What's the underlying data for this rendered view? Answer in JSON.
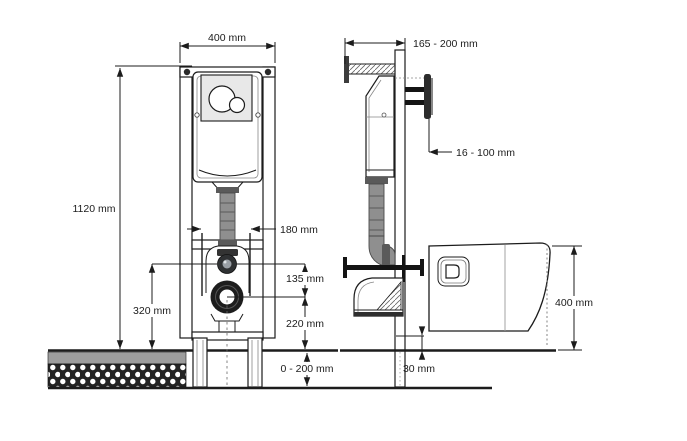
{
  "front_view": {
    "width": "400 mm",
    "height": "1120 mm",
    "fixing_bolt_spacing": "180 mm",
    "inlet_to_outlet": "135 mm",
    "water_inlet_height": "320 mm",
    "outlet_height": "220 mm",
    "floor_adjustment": "0 - 200 mm"
  },
  "side_view": {
    "frame_depth": "165 - 200 mm",
    "wall_clearance": "16 - 100 mm",
    "bowl_height": "400 mm",
    "floor_buildup": "30 mm"
  },
  "colors": {
    "ink": "#1c1c1c",
    "plate": "#e8e8e8",
    "pipe": "#8f8f8f",
    "pipe_dark": "#5a5a5a",
    "screed": "#9d9d9d",
    "base_layer": "#242424",
    "metal": "#141414"
  }
}
